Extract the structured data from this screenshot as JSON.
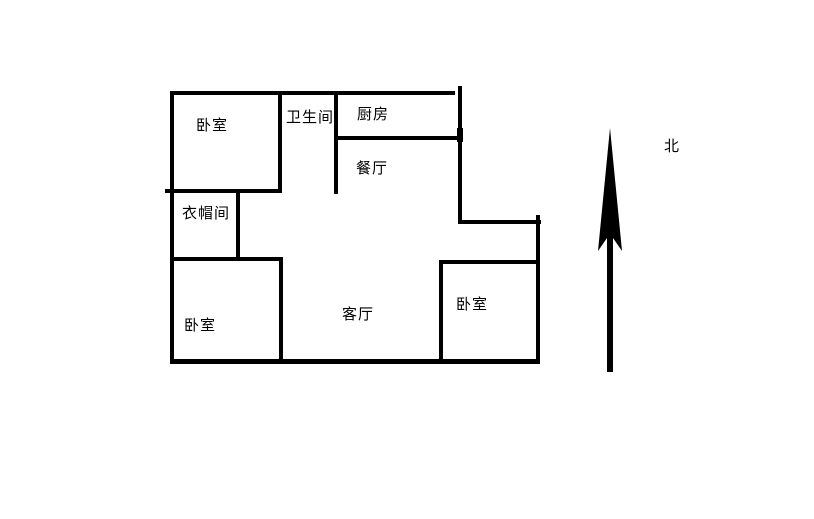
{
  "page": {
    "background_color": "#ffffff"
  },
  "floor_plan": {
    "wall_color": "#000000",
    "text_color": "#000000",
    "rooms": [
      {
        "id": "bedroom-north",
        "label": "卧室"
      },
      {
        "id": "bathroom",
        "label": "卫生间"
      },
      {
        "id": "kitchen",
        "label": "厨房"
      },
      {
        "id": "dining-room",
        "label": "餐厅"
      },
      {
        "id": "cloakroom",
        "label": "衣帽间"
      },
      {
        "id": "bedroom-southwest",
        "label": "卧室"
      },
      {
        "id": "living-room",
        "label": "客厅"
      },
      {
        "id": "bedroom-southeast",
        "label": "卧室"
      }
    ],
    "compass": {
      "label": "北",
      "direction": "up"
    }
  }
}
